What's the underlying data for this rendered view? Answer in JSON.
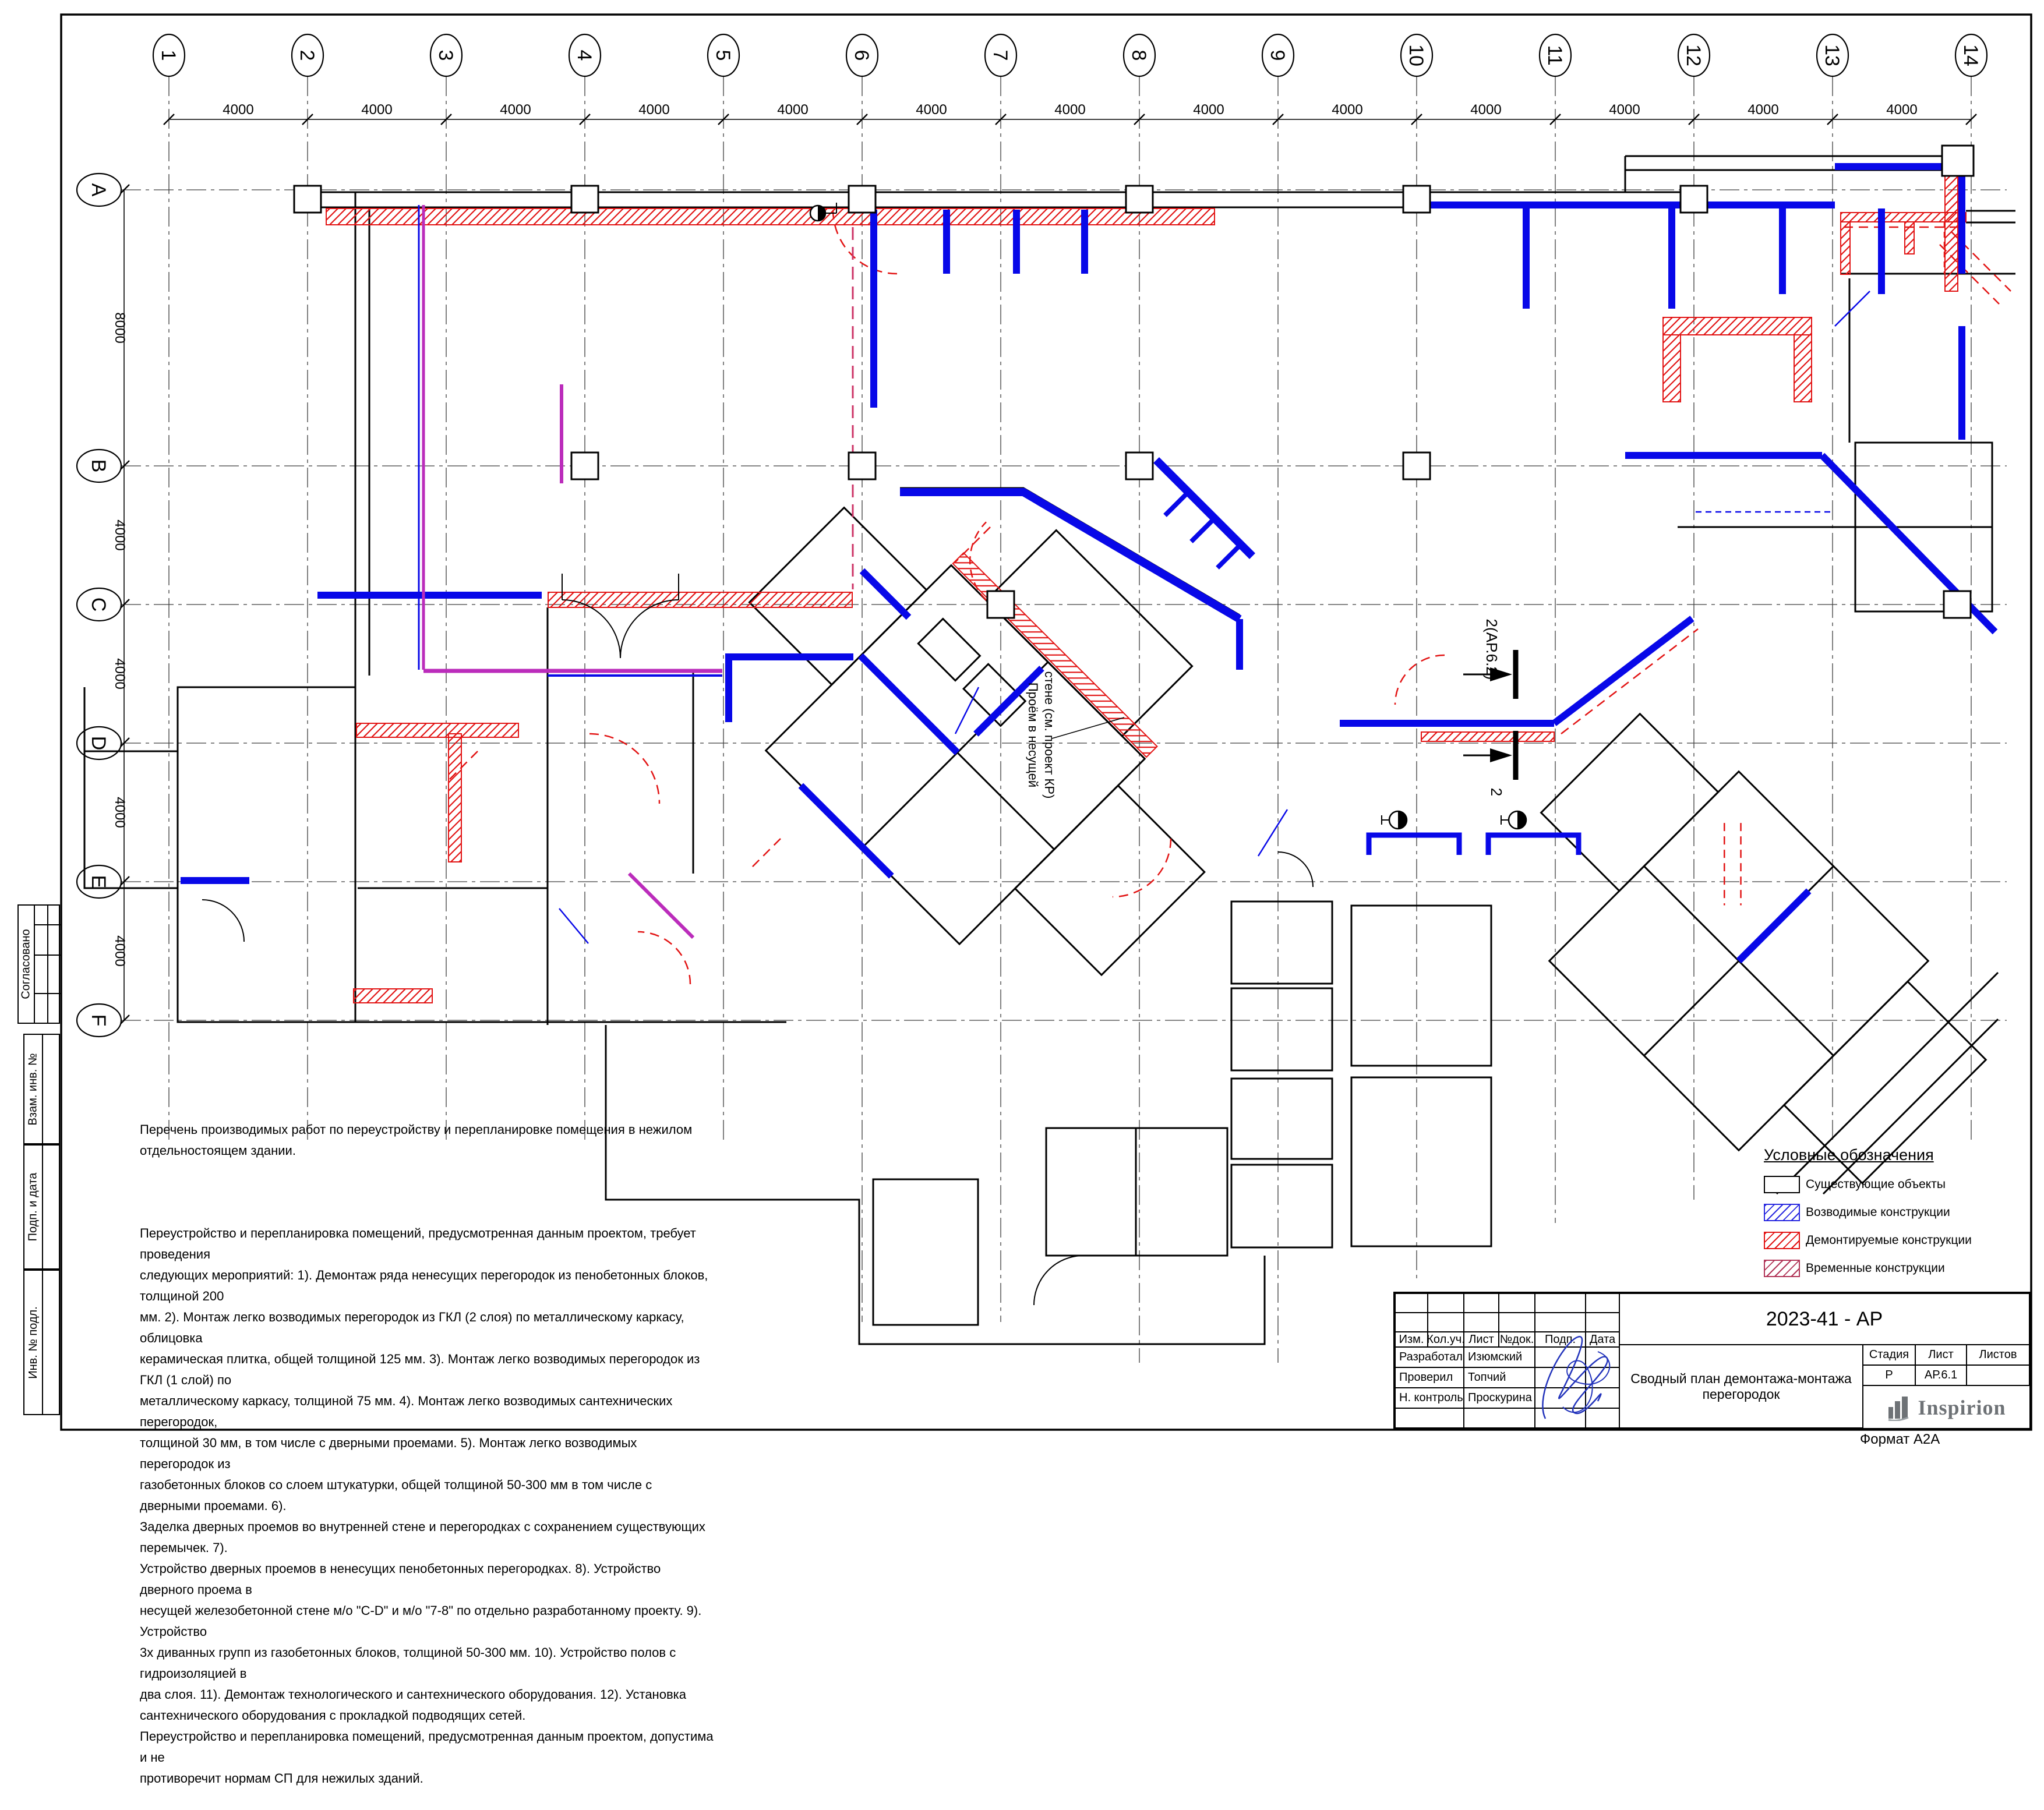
{
  "sheet": {
    "format_label": "Формат А2А"
  },
  "grid": {
    "columns": [
      "1",
      "2",
      "3",
      "4",
      "5",
      "6",
      "7",
      "8",
      "9",
      "10",
      "11",
      "12",
      "13",
      "14"
    ],
    "rows": [
      "A",
      "B",
      "C",
      "D",
      "E",
      "F"
    ],
    "top_dims": [
      "4000",
      "4000",
      "4000",
      "4000",
      "4000",
      "4000",
      "4000",
      "4000",
      "4000",
      "4000",
      "4000",
      "4000",
      "4000"
    ],
    "left_dims": [
      "8000",
      "4000",
      "4000",
      "4000",
      "4000"
    ]
  },
  "annotations": {
    "opening_line1": "Проём в несущей",
    "opening_line2": "стене (см. проект КР)",
    "section_label": "2(АР.6.2)",
    "section_number": "2"
  },
  "notes": {
    "heading": "Перечень производимых работ по переустройству и перепланировке помещения в нежилом\nотдельностоящем здании.",
    "body": "Переустройство и перепланировка помещений, предусмотренная данным проектом, требует проведения\nследующих мероприятий: 1). Демонтаж ряда ненесущих перегородок из пенобетонных блоков, толщиной 200\nмм. 2). Монтаж легко возводимых перегородок из ГКЛ (2 слоя) по металлическому каркасу, облицовка\nкерамическая плитка, общей толщиной 125 мм. 3). Монтаж легко возводимых перегородок из ГКЛ (1 слой) по\nметаллическому каркасу, толщиной 75 мм. 4). Монтаж легко возводимых сантехнических перегородок,\nтолщиной 30 мм, в том числе с дверными проемами. 5). Монтаж легко возводимых перегородок из\nгазобетонных блоков со слоем штукатурки, общей толщиной 50-300 мм в том числе с дверными проемами. 6).\nЗаделка дверных проемов во внутренней стене и перегородках с сохранением существующих перемычек. 7).\nУстройство дверных проемов в ненесущих пенобетонных перегородках. 8). Устройство дверного проема в\nнесущей железобетонной стене м/о \"C-D\" и м/о \"7-8\" по отдельно разработанному проекту. 9). Устройство\n3х диванных групп из газобетонных блоков, толщиной 50-300 мм. 10). Устройство полов с гидроизоляцией в\nдва слоя. 11). Демонтаж технологического и сантехнического оборудования. 12). Установка\nсантехнического оборудования с прокладкой подводящих сетей.\nПереустройство и перепланировка помещений, предусмотренная данным проектом, допустима и не\nпротиворечит нормам СП для нежилых зданий."
  },
  "legend": {
    "title": "Условные обозначения",
    "items": [
      {
        "label": "Существующие объекты",
        "type": "existing"
      },
      {
        "label": "Возводимые конструкции",
        "type": "new"
      },
      {
        "label": "Демонтируемые конструкции",
        "type": "demolish"
      },
      {
        "label": "Временные конструкции",
        "type": "temporary"
      }
    ]
  },
  "title_block": {
    "doc_code": "2023-41 - АР",
    "sheet_title": "Сводный план демонтажа-монтажа перегородок",
    "rev_headers": [
      "Изм.",
      "Кол.уч.",
      "Лист",
      "№док.",
      "Подп.",
      "Дата"
    ],
    "roles": [
      {
        "role": "Разработал",
        "name": "Изюмский"
      },
      {
        "role": "Проверил",
        "name": "Топчий"
      },
      {
        "role": "Н. контроль",
        "name": "Проскурина"
      }
    ],
    "stage_headers": [
      "Стадия",
      "Лист",
      "Листов"
    ],
    "stage": "Р",
    "sheet_no": "АР.6.1",
    "sheets_total": "",
    "logo": "Inspirion"
  },
  "stamps": {
    "approved": "Согласовано",
    "replace_inv": "Взам. инв. №",
    "sign_date": "Подп. и дата",
    "inv_no": "Инв. № подл."
  },
  "colors": {
    "new_construction": "#0808e8",
    "demolition": "#e21414",
    "temporary": "#b13558",
    "magenta": "#bb2cbb"
  }
}
